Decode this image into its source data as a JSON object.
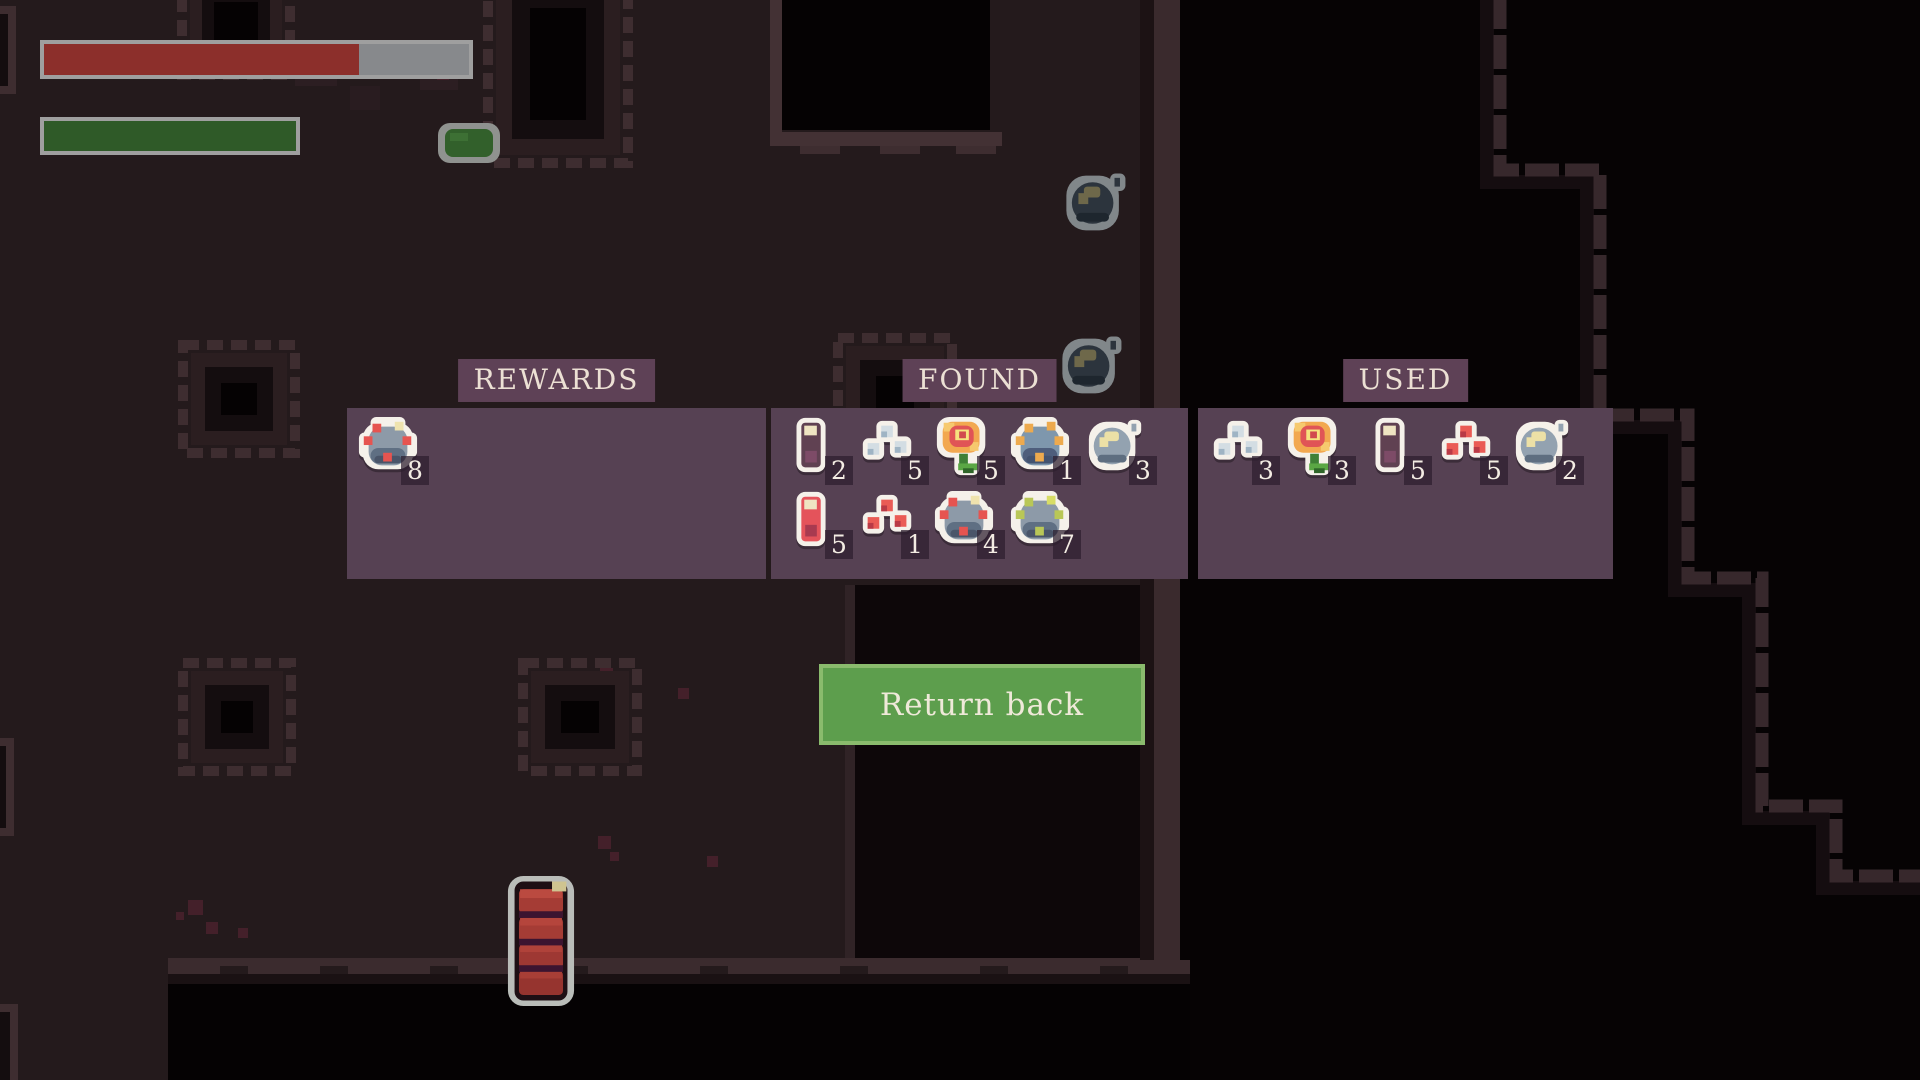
{
  "hud": {
    "health_bar": {
      "percent": 74,
      "fill_color": "#8c2f2b"
    },
    "stamina_bar": {
      "percent": 100,
      "fill_color": "#2f5a28"
    }
  },
  "panels": {
    "rewards": {
      "title": "REWARDS",
      "items": [
        {
          "name": "red-spore-mine",
          "count": 8
        }
      ]
    },
    "found": {
      "title": "FOUND",
      "items": [
        {
          "name": "purple-potion",
          "count": 2
        },
        {
          "name": "blue-cubes",
          "count": 5
        },
        {
          "name": "red-flower",
          "count": 5
        },
        {
          "name": "orange-spore-mine",
          "count": 1
        },
        {
          "name": "gray-bomb",
          "count": 3
        },
        {
          "name": "red-potion",
          "count": 5
        },
        {
          "name": "red-cubes",
          "count": 1
        },
        {
          "name": "red-spore-mine",
          "count": 4
        },
        {
          "name": "green-spore-mine",
          "count": 7
        }
      ]
    },
    "used": {
      "title": "USED",
      "items": [
        {
          "name": "blue-cubes",
          "count": 3
        },
        {
          "name": "red-flower",
          "count": 3
        },
        {
          "name": "purple-potion",
          "count": 5
        },
        {
          "name": "red-cubes",
          "count": 5
        },
        {
          "name": "gray-bomb",
          "count": 2
        }
      ]
    }
  },
  "action": {
    "return_button_label": "Return back"
  },
  "colors": {
    "panel_bg": "#564153",
    "label_bg": "#5e4156",
    "label_text": "#ece0d4",
    "button_bg": "#5d9e4d",
    "button_border": "#8abb6d",
    "button_text": "#efe9d9",
    "bar_border": "#9f9f9f",
    "bar_track": "#87898c",
    "floor": "#241a1c",
    "wall_light": "#3c2c2f",
    "sprite_outline": "#f5f1ea"
  }
}
